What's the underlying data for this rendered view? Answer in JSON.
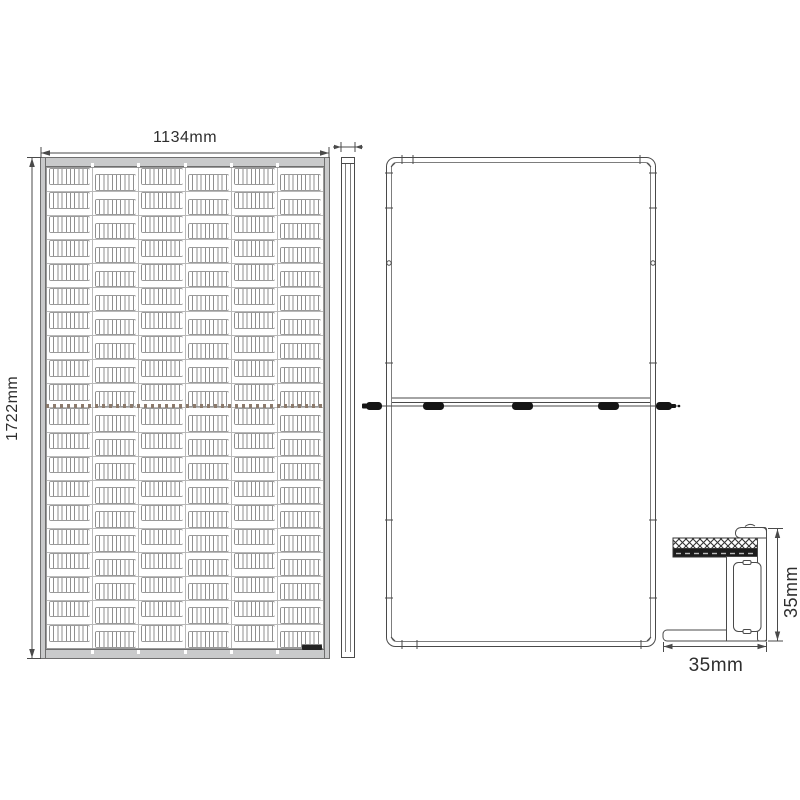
{
  "front_view": {
    "width_label": "1134mm",
    "height_label": "1722mm",
    "cells": {
      "columns": 6,
      "rows": 20
    }
  },
  "side_view": {
    "description": "edge profile view"
  },
  "back_view": {
    "junction_boxes": 3,
    "connectors": 2,
    "components": [
      "junction-box-left",
      "junction-box-center",
      "junction-box-right",
      "mc4-connector-left",
      "mc4-connector-right"
    ]
  },
  "section_view": {
    "height_label": "35mm",
    "width_label": "35mm"
  },
  "colors": {
    "line": "#4a4a4a",
    "frame_fill": "#c9cacb",
    "cell_line": "#8f8f8f",
    "divider_dots": "#8c7b6d",
    "connector_fill": "#151515"
  }
}
